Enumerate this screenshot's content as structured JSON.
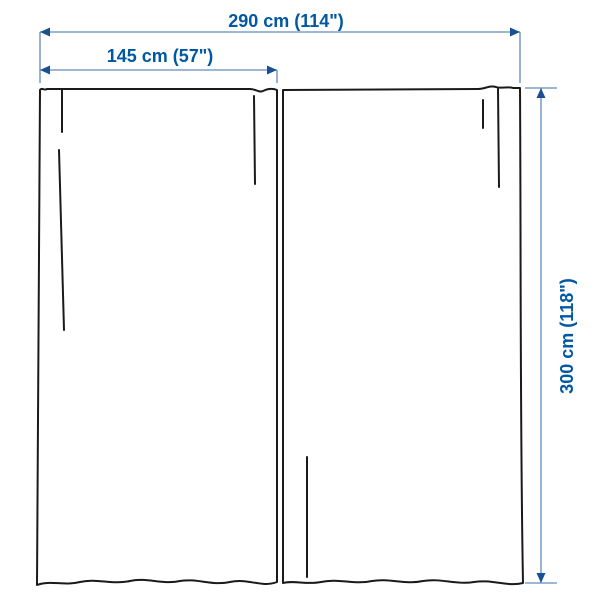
{
  "diagram": {
    "name": "curtain-pair-dimension-diagram",
    "panel_count": 2,
    "measurements": {
      "total_width": {
        "label": "290 cm (114\")",
        "value_cm": 290,
        "value_in": 114
      },
      "panel_width": {
        "label": "145 cm (57\")",
        "value_cm": 145,
        "value_in": 57
      },
      "height": {
        "label": "300 cm (118\")",
        "value_cm": 300,
        "value_in": 118
      }
    }
  },
  "colors": {
    "dimension_text": "#0058a3",
    "dimension_line": "#7f9fc9",
    "arrowhead": "#1a4f94",
    "curtain_outline": "#1a1a1a",
    "background": "#ffffff"
  }
}
